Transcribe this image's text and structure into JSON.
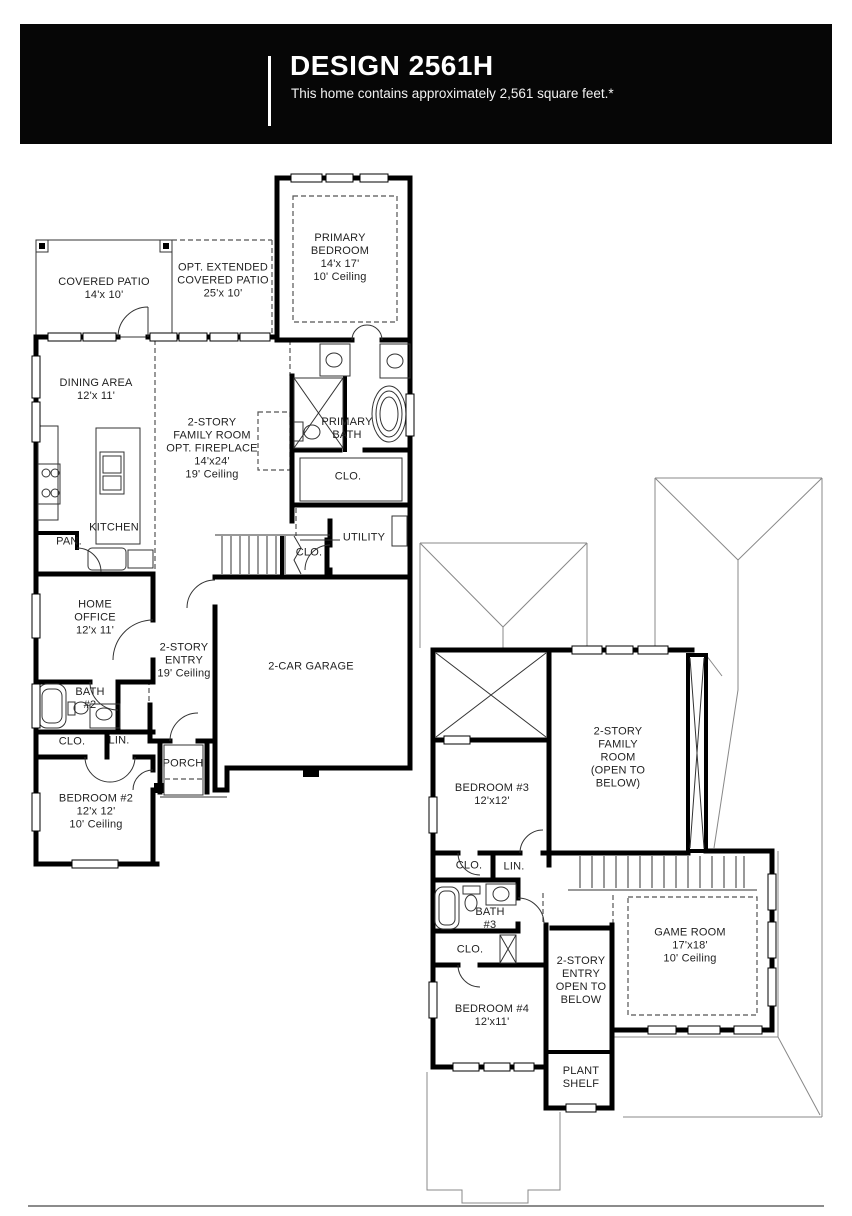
{
  "header": {
    "title": "DESIGN 2561H",
    "subtitle": "This home contains approximately 2,561 square feet.*"
  },
  "floor1": {
    "rooms": [
      {
        "id": "covered-patio",
        "label": "COVERED PATIO\n14'x 10'",
        "x": 104,
        "y": 289
      },
      {
        "id": "opt-extended-covered-patio",
        "label": "OPT. EXTENDED\nCOVERED PATIO\n25'x 10'",
        "x": 223,
        "y": 281
      },
      {
        "id": "primary-bedroom",
        "label": "PRIMARY\nBEDROOM\n14'x 17'\n10' Ceiling",
        "x": 340,
        "y": 258
      },
      {
        "id": "dining-area",
        "label": "DINING AREA\n12'x 11'",
        "x": 96,
        "y": 390
      },
      {
        "id": "family-room",
        "label": "2-STORY\nFAMILY ROOM\nOPT. FIREPLACE\n14'x24'\n19' Ceiling",
        "x": 212,
        "y": 449
      },
      {
        "id": "primary-bath",
        "label": "PRIMARY\nBATH",
        "x": 347,
        "y": 429
      },
      {
        "id": "primary-closet",
        "label": "CLO.",
        "x": 348,
        "y": 477
      },
      {
        "id": "kitchen",
        "label": "KITCHEN",
        "x": 114,
        "y": 528
      },
      {
        "id": "pantry",
        "label": "PAN.",
        "x": 69,
        "y": 542
      },
      {
        "id": "utility",
        "label": "UTILITY",
        "x": 364,
        "y": 538
      },
      {
        "id": "stair-closet",
        "label": "CLO.",
        "x": 309,
        "y": 553
      },
      {
        "id": "home-office",
        "label": "HOME\nOFFICE\n12'x 11'",
        "x": 95,
        "y": 618
      },
      {
        "id": "two-story-entry",
        "label": "2-STORY\nENTRY\n19' Ceiling",
        "x": 184,
        "y": 661
      },
      {
        "id": "garage",
        "label": "2-CAR GARAGE",
        "x": 311,
        "y": 667
      },
      {
        "id": "bath-2",
        "label": "BATH\n#2",
        "x": 90,
        "y": 699
      },
      {
        "id": "closet-bedroom2",
        "label": "CLO.",
        "x": 72,
        "y": 742
      },
      {
        "id": "linen",
        "label": "LIN.",
        "x": 119,
        "y": 741
      },
      {
        "id": "porch",
        "label": "PORCH",
        "x": 183,
        "y": 764
      },
      {
        "id": "bedroom-2",
        "label": "BEDROOM #2\n12'x 12'\n10' Ceiling",
        "x": 96,
        "y": 812
      }
    ],
    "fixtures": [
      "cooktop-icon",
      "kitchen-island-sink-icon",
      "pantry",
      "tub-icon",
      "toilet-icon",
      "sink-icon",
      "shower-icon",
      "stairs",
      "water-heater-icon"
    ]
  },
  "floor2": {
    "rooms": [
      {
        "id": "family-room-open-below",
        "label": "2-STORY\nFAMILY\nROOM\n(OPEN TO\nBELOW)",
        "x": 618,
        "y": 758
      },
      {
        "id": "bedroom-3",
        "label": "BEDROOM #3\n12'x12'",
        "x": 492,
        "y": 795
      },
      {
        "id": "closet-bedroom3",
        "label": "CLO.",
        "x": 469,
        "y": 866
      },
      {
        "id": "linen-2",
        "label": "LIN.",
        "x": 514,
        "y": 867
      },
      {
        "id": "bath-3",
        "label": "BATH\n#3",
        "x": 490,
        "y": 919
      },
      {
        "id": "closet-bedroom4",
        "label": "CLO.",
        "x": 470,
        "y": 950
      },
      {
        "id": "two-story-entry-open-below",
        "label": "2-STORY\nENTRY\nOPEN TO\nBELOW",
        "x": 581,
        "y": 981
      },
      {
        "id": "game-room",
        "label": "GAME ROOM\n17'x18'\n10' Ceiling",
        "x": 690,
        "y": 946
      },
      {
        "id": "bedroom-4",
        "label": "BEDROOM #4\n12'x11'",
        "x": 492,
        "y": 1016
      },
      {
        "id": "plant-shelf",
        "label": "PLANT\nSHELF",
        "x": 581,
        "y": 1078
      }
    ],
    "fixtures": [
      "tub-icon",
      "toilet-icon",
      "sink-icon",
      "linen-shelves-icon",
      "stairs",
      "fireplace-chase-icon",
      "roof-outline"
    ]
  }
}
